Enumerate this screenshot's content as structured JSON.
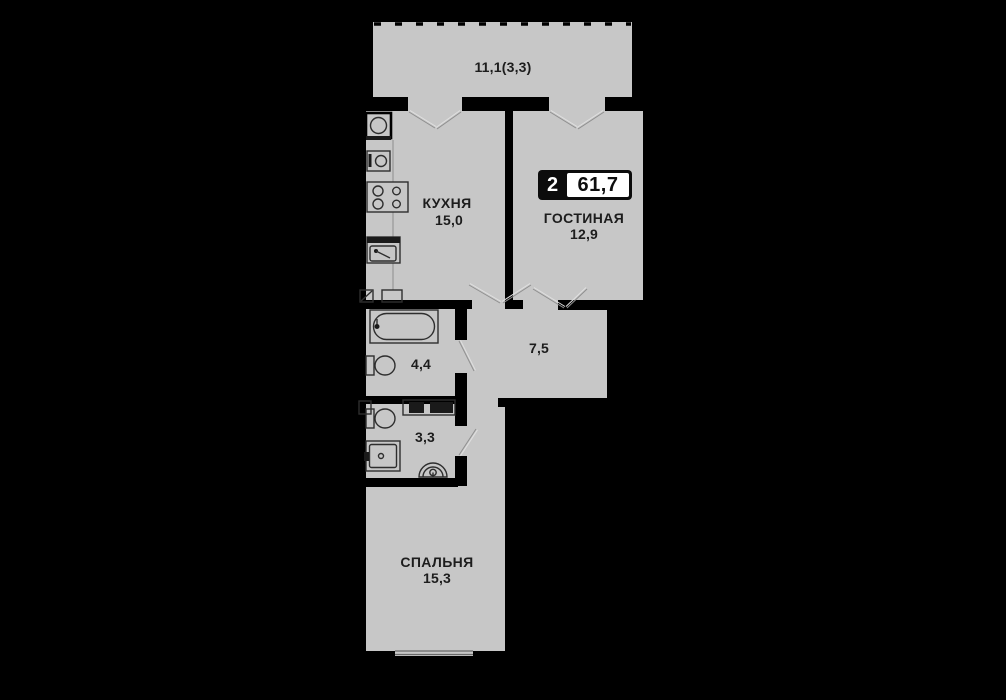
{
  "floor_plan": {
    "badge": {
      "room_count": "2",
      "total_area": "61,7"
    },
    "labels": {
      "balcony_area": "11,1(3,3)",
      "kitchen_name": "КУХНЯ",
      "kitchen_area": "15,0",
      "living_name": "ГОСТИНАЯ",
      "living_area": "12,9",
      "hall_area": "7,5",
      "bathroom_area": "4,4",
      "wc_area": "3,3",
      "bedroom_name": "СПАЛЬНЯ",
      "bedroom_area": "15,3"
    },
    "icons": [
      "balcony-railing",
      "door-swing",
      "stove-icon",
      "fridge-icon",
      "kitchen-sink-icon",
      "bathtub-icon",
      "toilet-icon",
      "bathroom-sink-icon",
      "washing-machine-icon",
      "vent-shaft-icon",
      "window-icon"
    ],
    "colors": {
      "background": "#000000",
      "floor": "#c7c7c7",
      "wall": "#000000",
      "badge_background": "#0c0c0c",
      "badge_number_box": "#ffffff",
      "label_text": "#1d1d1d"
    }
  }
}
